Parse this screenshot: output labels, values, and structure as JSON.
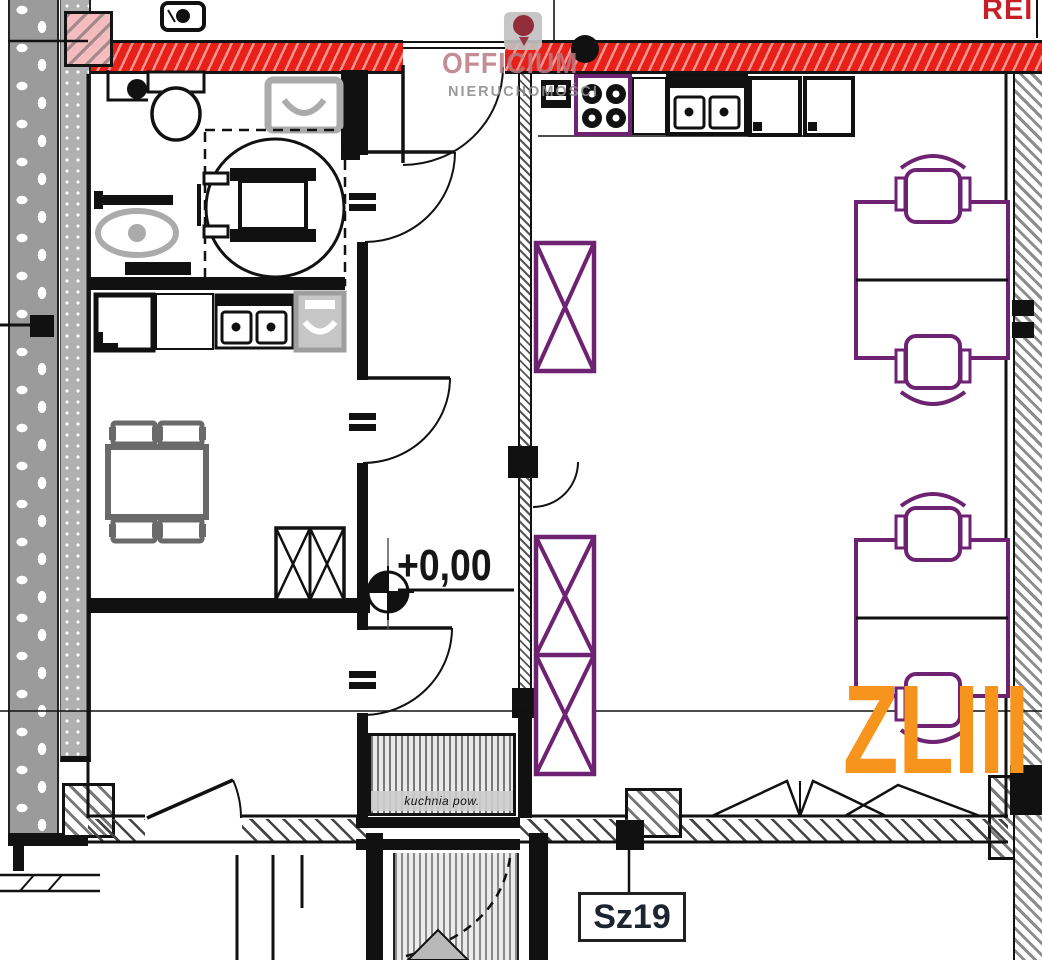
{
  "colors": {
    "fire_wall_red": "#e8201a",
    "column_pink": "#f4bcbe",
    "furniture_purple": "#6e2272",
    "zone_orange": "#f7941d",
    "rei_red": "#c62026",
    "fixture_gray": "#ababab"
  },
  "labels": {
    "rei_rating": "REI 1",
    "zone_class": "ZLIII",
    "level_marker": "+0,00",
    "room_tag": "Sz19",
    "stair_note": "kuchnia pow."
  },
  "watermark": {
    "line1": "OFFICIUM",
    "line2": "NIERUCHOMOŚCI"
  }
}
